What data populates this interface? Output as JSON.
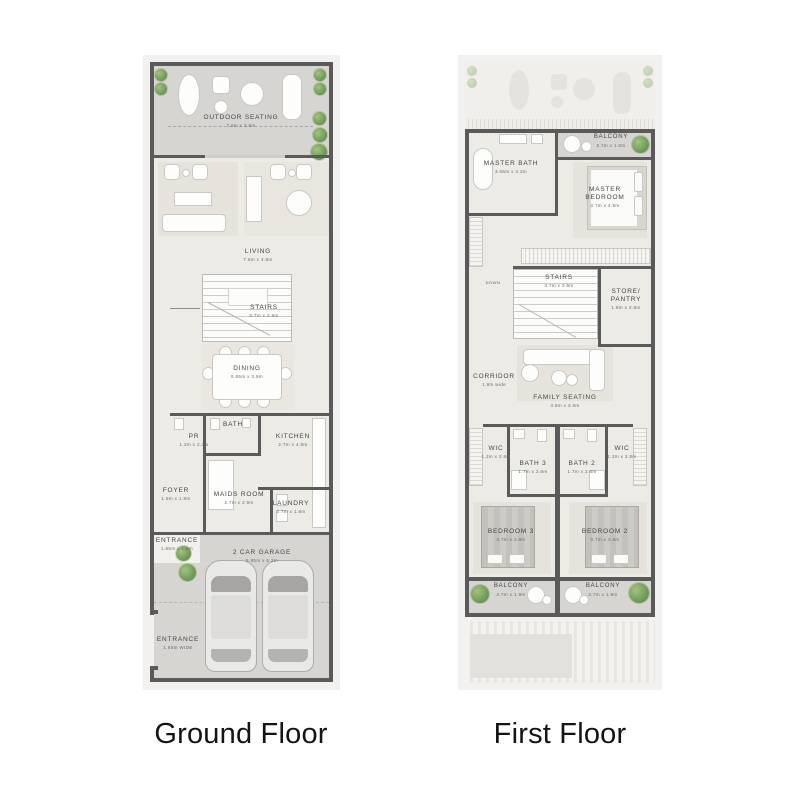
{
  "captions": {
    "ground": "Ground Floor",
    "first": "First Floor"
  },
  "colors": {
    "wall": "#5a5a5a",
    "interior_floor": "#edebe6",
    "outdoor_floor": "#d6d5d2",
    "plan_margin": "#f2f1ef",
    "label_text": "#454545",
    "plant_green": "#6f9c55",
    "page_background": "#ffffff"
  },
  "ground": {
    "rooms": {
      "outdoor_seating": {
        "name": "OUTDOOR SEATING",
        "dims": "7.6m x 3.8m"
      },
      "living": {
        "name": "LIVING",
        "dims": "7.6m x 4.8m"
      },
      "stairs": {
        "name": "STAIRS",
        "dims": "3.7m x 2.9m"
      },
      "dining": {
        "name": "DINING",
        "dims": "5.85m x 3.9m"
      },
      "pr": {
        "name": "PR",
        "dims": "1.2m x 2.2m"
      },
      "bath": {
        "name": "BATH"
      },
      "kitchen": {
        "name": "KITCHEN",
        "dims": "2.7m x 4.9m"
      },
      "foyer": {
        "name": "FOYER",
        "dims": "1.8m x 1.8m"
      },
      "maids_room": {
        "name": "MAIDS ROOM",
        "dims": "2.7m x 2.9m"
      },
      "laundry": {
        "name": "LAUNDRY",
        "dims": "2.7m x 1.8m"
      },
      "entrance_side": {
        "name": "ENTRANCE",
        "dims": "1.65m x 1.0m"
      },
      "garage": {
        "name": "2 CAR GARAGE",
        "dims": "5.85m x 6.2m"
      },
      "entrance_front": {
        "name": "ENTRANCE",
        "dims": "1.65m WIDE"
      }
    }
  },
  "first": {
    "rooms": {
      "balcony_top": {
        "name": "BALCONY",
        "dims": "3.7m x 1.0m"
      },
      "master_bath": {
        "name": "MASTER BATH",
        "dims": "3.65m x 3.2m"
      },
      "master_bedroom": {
        "name": "MASTER BEDROOM",
        "dims": "3.7m x 4.8m"
      },
      "stairs": {
        "name": "STAIRS",
        "dims": "3.7m x 2.9m"
      },
      "stairs_down": "DOWN",
      "store_pantry": {
        "name": "STORE/ PANTRY",
        "dims": "1.8m x 2.8m"
      },
      "corridor": {
        "name": "CORRIDOR",
        "dims": "1.9m wide"
      },
      "family_seating": {
        "name": "FAMILY SEATING",
        "dims": "3.8m x 3.8m"
      },
      "wic_left": {
        "name": "WIC",
        "dims": "1.2m x 2.8m"
      },
      "wic_right": {
        "name": "WIC",
        "dims": "1.2m x 2.8m"
      },
      "bath_3": {
        "name": "BATH 3",
        "dims": "1.7m x 2.5m"
      },
      "bath_2": {
        "name": "BATH 2",
        "dims": "1.7m x 2.6m"
      },
      "bedroom_3": {
        "name": "BEDROOM 3",
        "dims": "3.7m x 3.8m"
      },
      "bedroom_2": {
        "name": "BEDROOM 2",
        "dims": "3.7m x 3.8m"
      },
      "balcony_left": {
        "name": "BALCONY",
        "dims": "3.7m x 1.9m"
      },
      "balcony_right": {
        "name": "BALCONY",
        "dims": "3.7m x 1.9m"
      }
    }
  }
}
